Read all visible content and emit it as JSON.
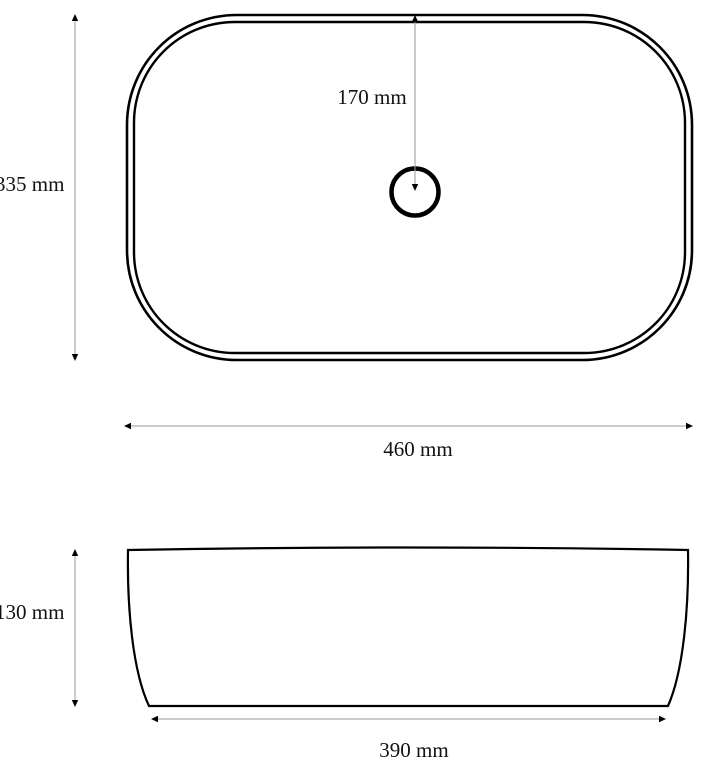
{
  "diagram": {
    "type": "technical-drawing",
    "subject": "countertop-basin-dimension-drawing",
    "colors": {
      "outline": "#000000",
      "dimension_line": "#9a9a9a",
      "label": "#111111",
      "background": "#ffffff"
    },
    "top_view": {
      "depth_label": "335 mm",
      "width_label": "460 mm",
      "drain_offset_label": "170 mm"
    },
    "side_view": {
      "height_label": "130 mm",
      "base_width_label": "390 mm"
    },
    "dimensions_mm": {
      "top_depth": 335,
      "top_width": 460,
      "drain_offset_from_edge": 170,
      "body_height": 130,
      "base_width": 390
    }
  }
}
